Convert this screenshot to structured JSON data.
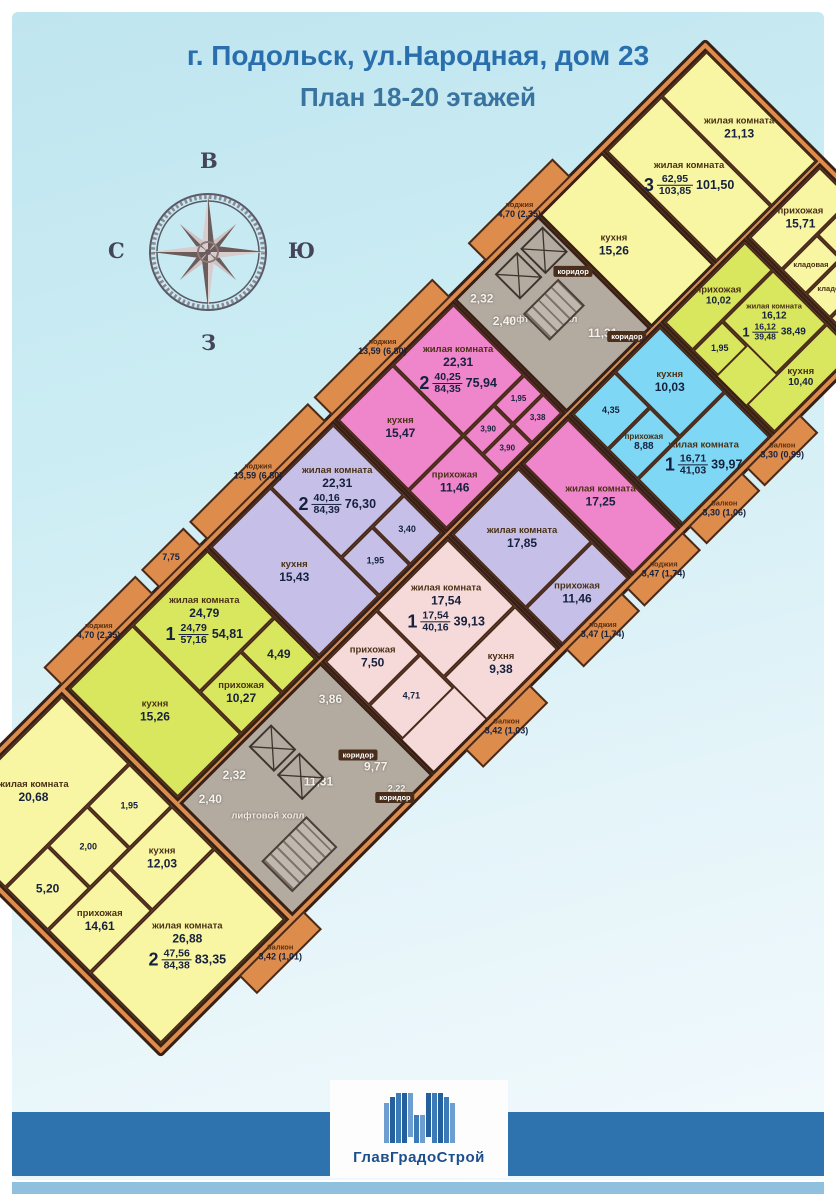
{
  "page": {
    "title_line1": "г. Подольск, ул.Народная, дом 23",
    "title_line2": "План 18-20 этажей"
  },
  "compass": {
    "top": "В",
    "right": "Ю",
    "bottom": "З",
    "left": "С"
  },
  "logo": {
    "company": "ГлавГрадоСтрой"
  },
  "colors": {
    "title_blue": "#2a6fad",
    "footer_band": "#2e73ae",
    "walls_orange": "#dd8c4c",
    "apartment_yellow": "#f8f6a3",
    "apartment_green": "#d9e75e",
    "apartment_magenta": "#ef85ca",
    "apartment_purple": "#c6c0e8",
    "apartment_light_pink": "#f6dada",
    "apartment_blue": "#7ed7f4",
    "core_gray": "#b3aaa0",
    "wall_dark": "#3f2517"
  },
  "shared": {
    "living": "жилая комната",
    "kitchen": "кухня",
    "hall": "прихожая",
    "corridor": "коридор",
    "storage": "кладовая",
    "lift_hall": "лифтовой холл",
    "loggia": "лоджия",
    "balcony": "балкон"
  },
  "apartments": {
    "sw2": {
      "count": "2",
      "area_living": "47,56",
      "area_total": "84,38",
      "area_net": "83,35",
      "living1": "20,68",
      "living2": "26,88",
      "hall": "14,61",
      "kitchen": "12,03",
      "bath": "5,20",
      "wc": "2,00",
      "wc2": "1,95",
      "balcony": "3,42 (1,01)"
    },
    "green57": {
      "count": "1",
      "area_living": "24,79",
      "area_total": "57,16",
      "area_net": "54,81",
      "living": "24,79",
      "kitchen": "15,26",
      "hall": "10,27",
      "bath": "4,49",
      "loggia": "4,70 (2,35)"
    },
    "purple84": {
      "count": "2",
      "area_living": "40,16",
      "area_total": "84,39",
      "area_net": "76,30",
      "living1": "22,31",
      "living2": "17,85",
      "kitchen": "15,43",
      "hall": "11,46",
      "bath": "1,95",
      "wc": "3,40"
    },
    "magenta84": {
      "count": "2",
      "area_living": "40,25",
      "area_total": "84,35",
      "area_net": "75,94",
      "living1": "22,31",
      "living2": "17,25",
      "kitchen": "15,47",
      "hall": "11,46",
      "bath1": "3,90",
      "bath2": "3,90",
      "wc": "1,95",
      "wc2": "3,38"
    },
    "pink40": {
      "count": "1",
      "area_living": "17,54",
      "area_total": "40,16",
      "area_net": "39,13",
      "living": "17,54",
      "kitchen": "9,38",
      "hall": "7,50",
      "bath": "4,71",
      "balcony": "3,42 (1,03)"
    },
    "blue41": {
      "count": "1",
      "area_living": "16,71",
      "area_total": "41,03",
      "area_net": "39,97",
      "kitchen": "10,03",
      "hall": "8,88",
      "bath": "4,35",
      "balcony1": "3,30 (1,06)",
      "balcony2": "3,30 (0,99)"
    },
    "green39": {
      "count": "1",
      "area_living": "16,12",
      "area_total": "39,48",
      "area_net": "38,49",
      "living": "16,12",
      "kitchen": "10,40",
      "hall": "10,02",
      "bath": "1,95"
    },
    "ne3": {
      "count": "3",
      "area_living": "62,95",
      "area_total": "103,85",
      "area_net": "101,50",
      "living2": "21,13",
      "living3": "18,24",
      "kitchen": "15,26",
      "hall": "15,71",
      "bath": "4,50",
      "loggia": "4,70 (2,35)"
    }
  },
  "cores": {
    "top": {
      "r1": "2,32",
      "r2": "2,40",
      "corr": "11,31"
    },
    "bottom": {
      "r1": "2,40",
      "r2": "2,32",
      "corr": "11,31",
      "corr2": "9,77",
      "corr3": "2,22",
      "c1": "3,86"
    }
  },
  "loggias": {
    "left1": "13,59 (6,80)",
    "left2": "13,59 (6,80)",
    "left3": "7,75",
    "right1": "3,47 (1,74)",
    "right2": "3,47 (1,74)"
  }
}
